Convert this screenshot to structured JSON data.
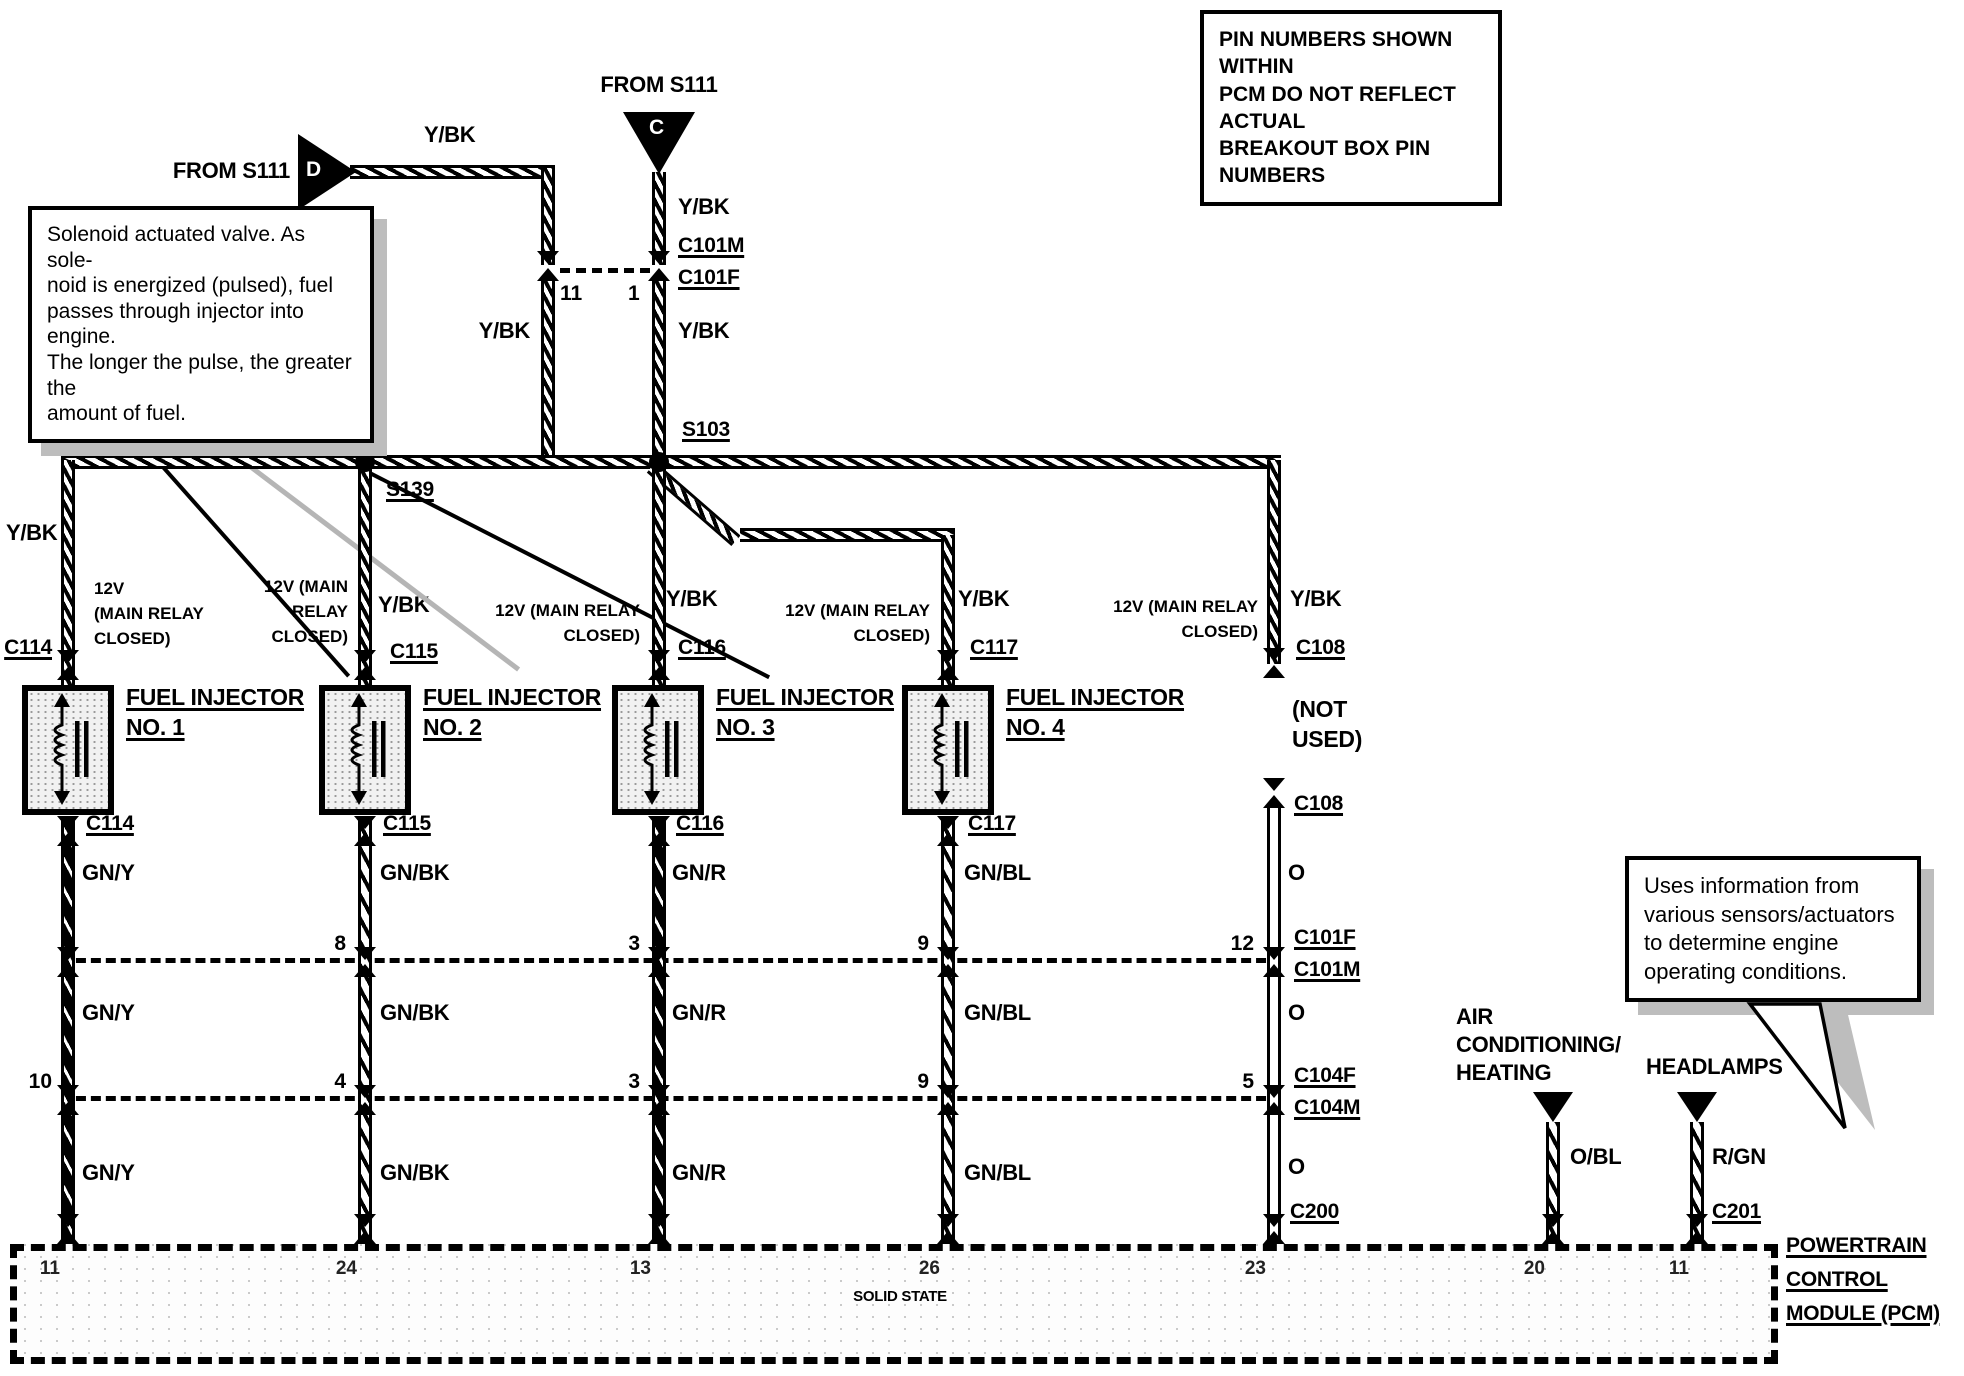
{
  "colors": {
    "ink": "#000000",
    "paper": "#ffffff",
    "shadow": "#bdbdbd"
  },
  "header_note": {
    "lines": [
      "PIN NUMBERS SHOWN WITHIN",
      "PCM DO NOT REFLECT ACTUAL",
      "BREAKOUT BOX PIN NUMBERS"
    ]
  },
  "solenoid_note": {
    "lines": [
      "Solenoid actuated valve.  As sole-",
      "noid is energized (pulsed), fuel",
      "passes through injector into engine.",
      "The longer the pulse, the greater the",
      "amount of fuel."
    ]
  },
  "pcm_note": {
    "lines": [
      "Uses information from",
      "various sensors/actuators",
      "to determine engine",
      "operating conditions."
    ]
  },
  "sources": {
    "left": {
      "label": "FROM S111",
      "letter": "D",
      "wire": "Y/BK"
    },
    "top": {
      "label": "FROM S111",
      "letter": "C",
      "wire": "Y/BK"
    }
  },
  "top_connector": {
    "name_top": "C101M",
    "name_bottom": "C101F",
    "pin_left": "11",
    "pin_right": "1"
  },
  "splices": {
    "s139": "S139",
    "s103": "S103"
  },
  "columns": [
    {
      "supply": [
        "12V",
        "(MAIN RELAY",
        "CLOSED)"
      ],
      "supply_wire": "Y/BK",
      "conn_top": "C114",
      "device": [
        "FUEL INJECTOR",
        "NO. 1"
      ],
      "conn_bottom": "C114",
      "wire_color": "GN/Y",
      "pin_row1": "",
      "pin_row2": "10"
    },
    {
      "supply": [
        "12V (MAIN",
        "RELAY",
        "CLOSED)"
      ],
      "supply_wire": "Y/BK",
      "conn_top": "C115",
      "device": [
        "FUEL INJECTOR",
        "NO. 2"
      ],
      "conn_bottom": "C115",
      "wire_color": "GN/BK",
      "pin_row1": "8",
      "pin_row2": "4"
    },
    {
      "supply": [
        "12V (MAIN RELAY",
        "CLOSED)"
      ],
      "supply_wire": "Y/BK",
      "conn_top": "C116",
      "device": [
        "FUEL INJECTOR",
        "NO. 3"
      ],
      "conn_bottom": "C116",
      "wire_color": "GN/R",
      "pin_row1": "3",
      "pin_row2": "3"
    },
    {
      "supply": [
        "12V (MAIN RELAY",
        "CLOSED)"
      ],
      "supply_wire": "Y/BK",
      "conn_top": "C117",
      "device": [
        "FUEL INJECTOR",
        "NO. 4"
      ],
      "conn_bottom": "C117",
      "wire_color": "GN/BL",
      "pin_row1": "9",
      "pin_row2": "9"
    },
    {
      "supply": [
        "12V (MAIN RELAY",
        "CLOSED)"
      ],
      "supply_wire": "Y/BK",
      "conn_top": "C108",
      "device": [
        "(NOT",
        "USED)"
      ],
      "conn_bottom": "C108",
      "wire_color": "O",
      "pin_row1": "12",
      "pin_row2": "5",
      "conn_pcm": "C200"
    }
  ],
  "row1_connector": {
    "labels": [
      "C101F",
      "C101M"
    ]
  },
  "row2_connector": {
    "labels": [
      "C104F",
      "C104M"
    ]
  },
  "inputs": [
    {
      "label": [
        "AIR",
        "CONDITIONING/",
        "HEATING"
      ],
      "wire": "O/BL"
    },
    {
      "label": [
        "HEADLAMPS"
      ],
      "wire": "R/GN",
      "conn": "C201"
    }
  ],
  "pcm": {
    "center_label": "SOLID STATE",
    "name": [
      "POWERTRAIN",
      "CONTROL",
      "MODULE (PCM)"
    ],
    "pins": [
      "11",
      "24",
      "13",
      "26",
      "23",
      "20",
      "11"
    ]
  }
}
